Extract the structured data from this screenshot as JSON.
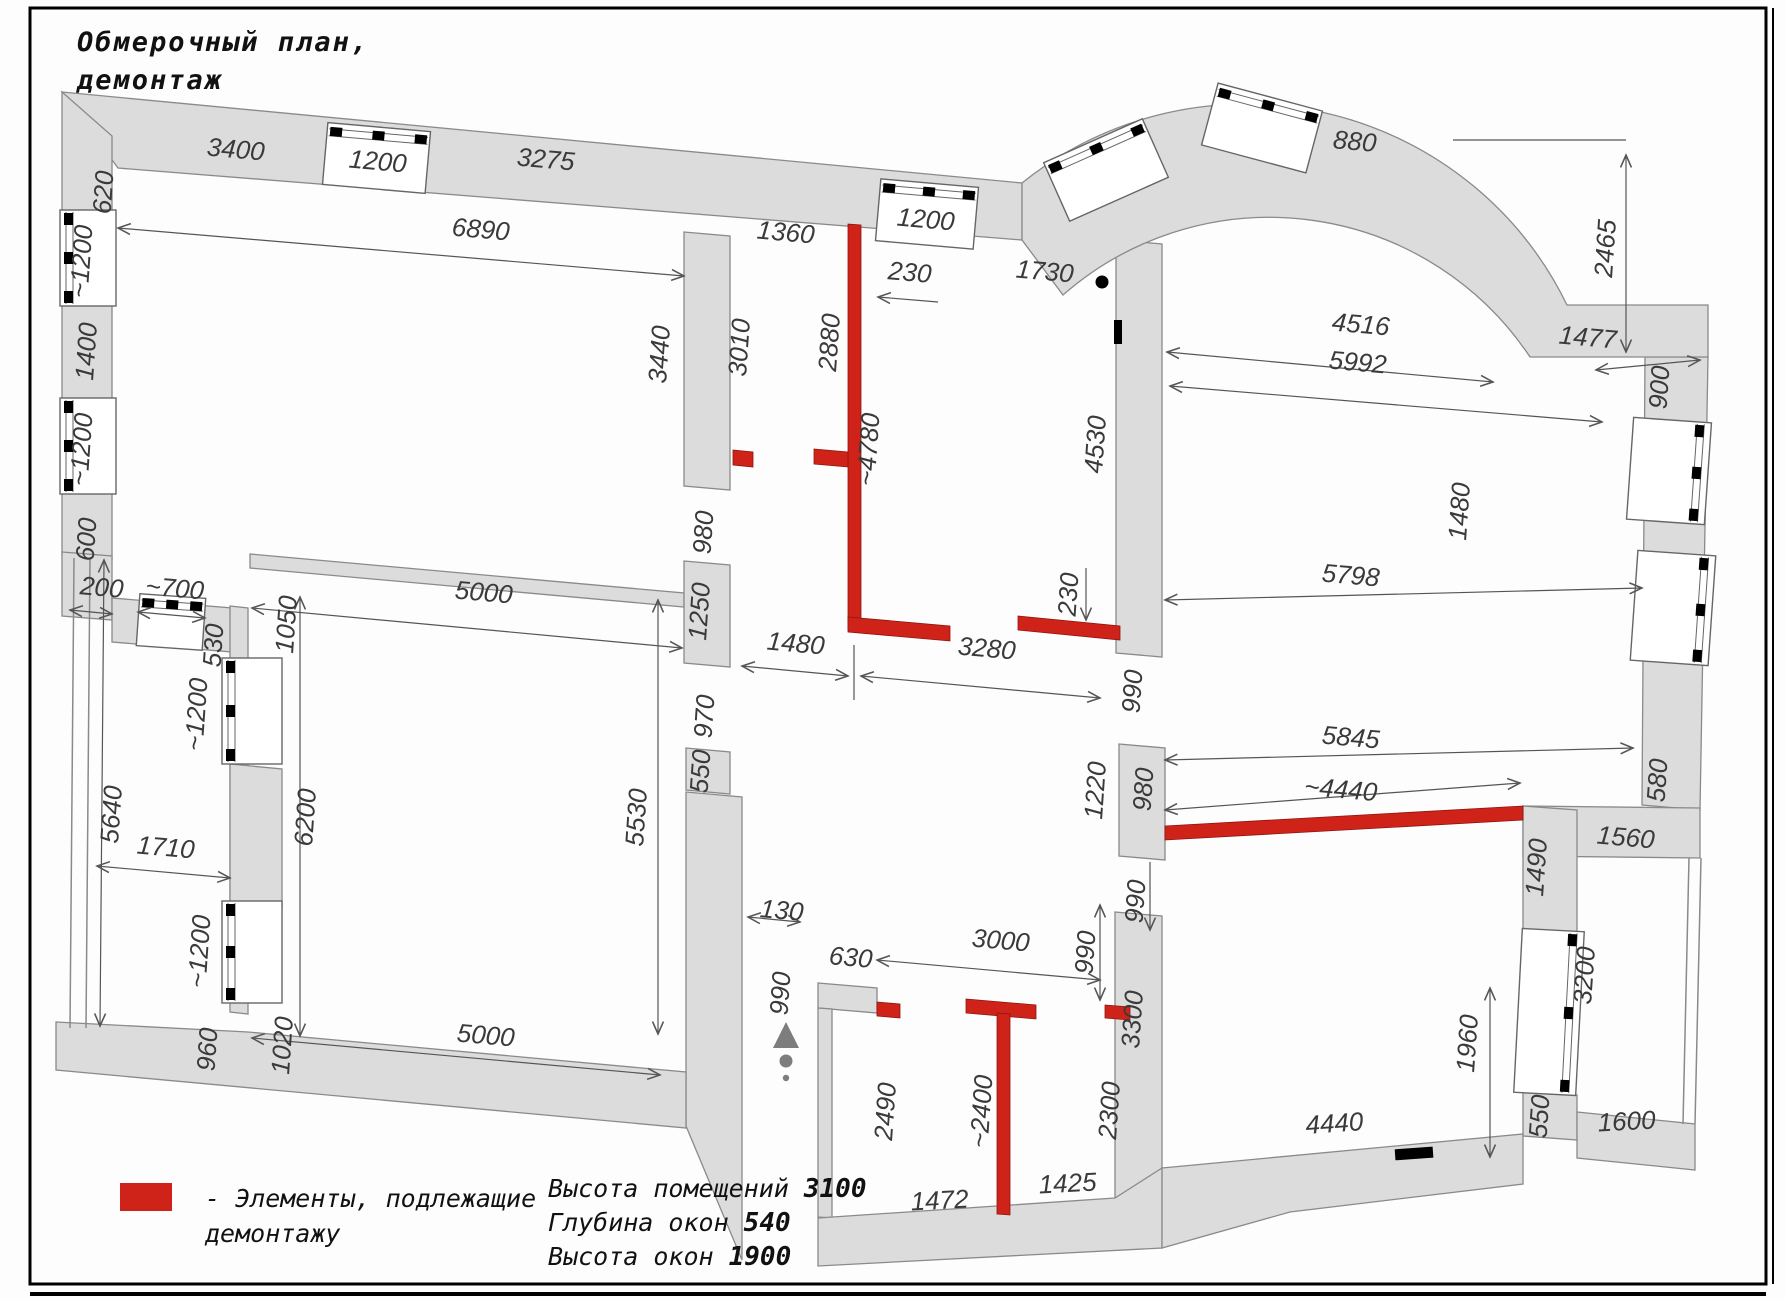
{
  "title": {
    "line1": "Обмерочный план,",
    "line2": "демонтаж"
  },
  "legend": {
    "swatch_color": "#cf231a",
    "line1": "- Элементы, подлежащие",
    "line2": "демонтажу"
  },
  "notes": [
    {
      "label": "Высота помещений ",
      "value": "3100"
    },
    {
      "label": "Глубина окон ",
      "value": "540"
    },
    {
      "label": "Высота окон ",
      "value": "1900"
    }
  ],
  "colors": {
    "wall_fill": "#dcdcdc",
    "wall_stroke": "#8a8a8a",
    "demolition_red": "#cf231a",
    "dim_text": "#3a3a3a",
    "frame": "#000000",
    "entry_marker": "#7d7d7d"
  },
  "icons": [
    {
      "name": "entry-direction-icon",
      "desc": "triangle with dots marking entrance"
    },
    {
      "name": "door-pivot-icon",
      "desc": "black dot door pivot"
    }
  ],
  "plan_labels": [
    {
      "text": "3400",
      "x": 235,
      "y": 158,
      "r": 5
    },
    {
      "text": "1200",
      "x": 377,
      "y": 170,
      "r": 5
    },
    {
      "text": "3275",
      "x": 545,
      "y": 168,
      "r": 5
    },
    {
      "text": "6890",
      "x": 480,
      "y": 238,
      "r": 5
    },
    {
      "text": "1360",
      "x": 785,
      "y": 241,
      "r": 5
    },
    {
      "text": "230",
      "x": 909,
      "y": 281,
      "r": 5
    },
    {
      "text": "1730",
      "x": 1044,
      "y": 280,
      "r": 5
    },
    {
      "text": "1200",
      "x": 925,
      "y": 228,
      "r": 5
    },
    {
      "text": "880",
      "x": 1354,
      "y": 150,
      "r": 5
    },
    {
      "text": "4516",
      "x": 1360,
      "y": 333,
      "r": 5
    },
    {
      "text": "5992",
      "x": 1357,
      "y": 371,
      "r": 5
    },
    {
      "text": "1477",
      "x": 1587,
      "y": 346,
      "r": 5
    },
    {
      "text": "2465",
      "x": 1614,
      "y": 249,
      "r": -86
    },
    {
      "text": "900",
      "x": 1668,
      "y": 388,
      "r": -86
    },
    {
      "text": "5798",
      "x": 1350,
      "y": 584,
      "r": 5
    },
    {
      "text": "1480",
      "x": 1468,
      "y": 512,
      "r": -86
    },
    {
      "text": "5845",
      "x": 1350,
      "y": 746,
      "r": 5
    },
    {
      "text": "~4440",
      "x": 1340,
      "y": 798,
      "r": 5
    },
    {
      "text": "580",
      "x": 1666,
      "y": 781,
      "r": -86
    },
    {
      "text": "1560",
      "x": 1625,
      "y": 846,
      "r": 5
    },
    {
      "text": "1490",
      "x": 1545,
      "y": 868,
      "r": -86
    },
    {
      "text": "1960",
      "x": 1476,
      "y": 1044,
      "r": -86
    },
    {
      "text": "3200",
      "x": 1593,
      "y": 976,
      "r": -86
    },
    {
      "text": "550",
      "x": 1548,
      "y": 1117,
      "r": -86
    },
    {
      "text": "1600",
      "x": 1627,
      "y": 1130,
      "r": -3
    },
    {
      "text": "4440",
      "x": 1335,
      "y": 1132,
      "r": -4
    },
    {
      "text": "620",
      "x": 112,
      "y": 193,
      "r": -86
    },
    {
      "text": "~1200",
      "x": 90,
      "y": 262,
      "r": -86
    },
    {
      "text": "1400",
      "x": 95,
      "y": 352,
      "r": -86
    },
    {
      "text": "~1200",
      "x": 90,
      "y": 450,
      "r": -86
    },
    {
      "text": "600",
      "x": 95,
      "y": 540,
      "r": -86
    },
    {
      "text": "200",
      "x": 101,
      "y": 596,
      "r": 5
    },
    {
      "text": "~700",
      "x": 174,
      "y": 597,
      "r": 5
    },
    {
      "text": "530",
      "x": 222,
      "y": 646,
      "r": -86
    },
    {
      "text": "1050",
      "x": 295,
      "y": 625,
      "r": -86
    },
    {
      "text": "~1200",
      "x": 205,
      "y": 715,
      "r": -86
    },
    {
      "text": "6200",
      "x": 314,
      "y": 818,
      "r": -86
    },
    {
      "text": "~1200",
      "x": 208,
      "y": 952,
      "r": -86
    },
    {
      "text": "5640",
      "x": 120,
      "y": 815,
      "r": -86
    },
    {
      "text": "1710",
      "x": 165,
      "y": 856,
      "r": 5
    },
    {
      "text": "960",
      "x": 216,
      "y": 1050,
      "r": -86
    },
    {
      "text": "1020",
      "x": 291,
      "y": 1046,
      "r": -86
    },
    {
      "text": "5000",
      "x": 483,
      "y": 601,
      "r": 5
    },
    {
      "text": "5000",
      "x": 485,
      "y": 1044,
      "r": 5
    },
    {
      "text": "5530",
      "x": 645,
      "y": 818,
      "r": -86
    },
    {
      "text": "3440",
      "x": 668,
      "y": 355,
      "r": -86
    },
    {
      "text": "3010",
      "x": 748,
      "y": 348,
      "r": -86
    },
    {
      "text": "980",
      "x": 712,
      "y": 533,
      "r": -86
    },
    {
      "text": "1250",
      "x": 708,
      "y": 612,
      "r": -86
    },
    {
      "text": "970",
      "x": 713,
      "y": 717,
      "r": -86
    },
    {
      "text": "550",
      "x": 709,
      "y": 772,
      "r": -86
    },
    {
      "text": "2880",
      "x": 838,
      "y": 343,
      "r": -86
    },
    {
      "text": "~4780",
      "x": 877,
      "y": 450,
      "r": -86
    },
    {
      "text": "1480",
      "x": 795,
      "y": 652,
      "r": 5
    },
    {
      "text": "3280",
      "x": 986,
      "y": 657,
      "r": 5
    },
    {
      "text": "4530",
      "x": 1104,
      "y": 445,
      "r": -86
    },
    {
      "text": "230",
      "x": 1077,
      "y": 595,
      "r": -86
    },
    {
      "text": "990",
      "x": 1141,
      "y": 692,
      "r": -86
    },
    {
      "text": "1220",
      "x": 1104,
      "y": 791,
      "r": -86
    },
    {
      "text": "980",
      "x": 1152,
      "y": 790,
      "r": -86
    },
    {
      "text": "990",
      "x": 1144,
      "y": 902,
      "r": -86
    },
    {
      "text": "990",
      "x": 1094,
      "y": 953,
      "r": -86
    },
    {
      "text": "3300",
      "x": 1141,
      "y": 1020,
      "r": -86
    },
    {
      "text": "130",
      "x": 781,
      "y": 919,
      "r": 5
    },
    {
      "text": "990",
      "x": 789,
      "y": 994,
      "r": -86
    },
    {
      "text": "630",
      "x": 850,
      "y": 966,
      "r": 5
    },
    {
      "text": "3000",
      "x": 1000,
      "y": 949,
      "r": 5
    },
    {
      "text": "2490",
      "x": 894,
      "y": 1112,
      "r": -86
    },
    {
      "text": "~2400",
      "x": 990,
      "y": 1112,
      "r": -86
    },
    {
      "text": "2300",
      "x": 1118,
      "y": 1111,
      "r": -86
    },
    {
      "text": "1472",
      "x": 940,
      "y": 1209,
      "r": -3
    },
    {
      "text": "1425",
      "x": 1068,
      "y": 1192,
      "r": -3
    }
  ]
}
